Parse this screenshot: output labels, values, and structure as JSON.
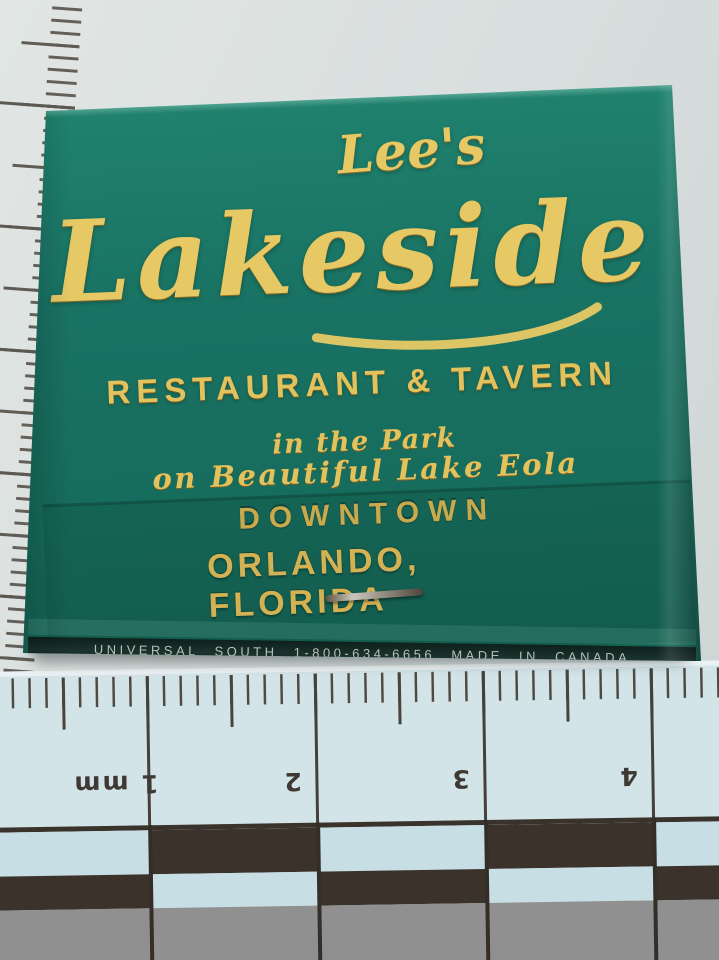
{
  "matchbook": {
    "script_small": "Lee's",
    "script_large": "Lakeside",
    "subtitle": "RESTAURANT & TAVERN",
    "tagline1": "in the Park",
    "tagline2": "on Beautiful Lake Eola",
    "flap_line1": "DOWNTOWN",
    "flap_line2": "ORLANDO, FLORIDA",
    "bottom_strip": "UNIVERSAL SOUTH 1-800-634-6656 MADE IN CANADA"
  },
  "ruler": {
    "label_1": "1 mm",
    "label_2": "2",
    "label_3": "3",
    "label_4": "4"
  },
  "colors": {
    "matchbook_green": "#197263",
    "foil_gold": "#e6c964",
    "worn_gold": "#c9a94e",
    "background": "#d9dfde",
    "ruler_paper": "#d3e4e9",
    "checker_dark": "#3a322b",
    "band_gray": "#8f908f",
    "strip_bg": "#13251f",
    "strip_text": "#c6ccc8"
  }
}
